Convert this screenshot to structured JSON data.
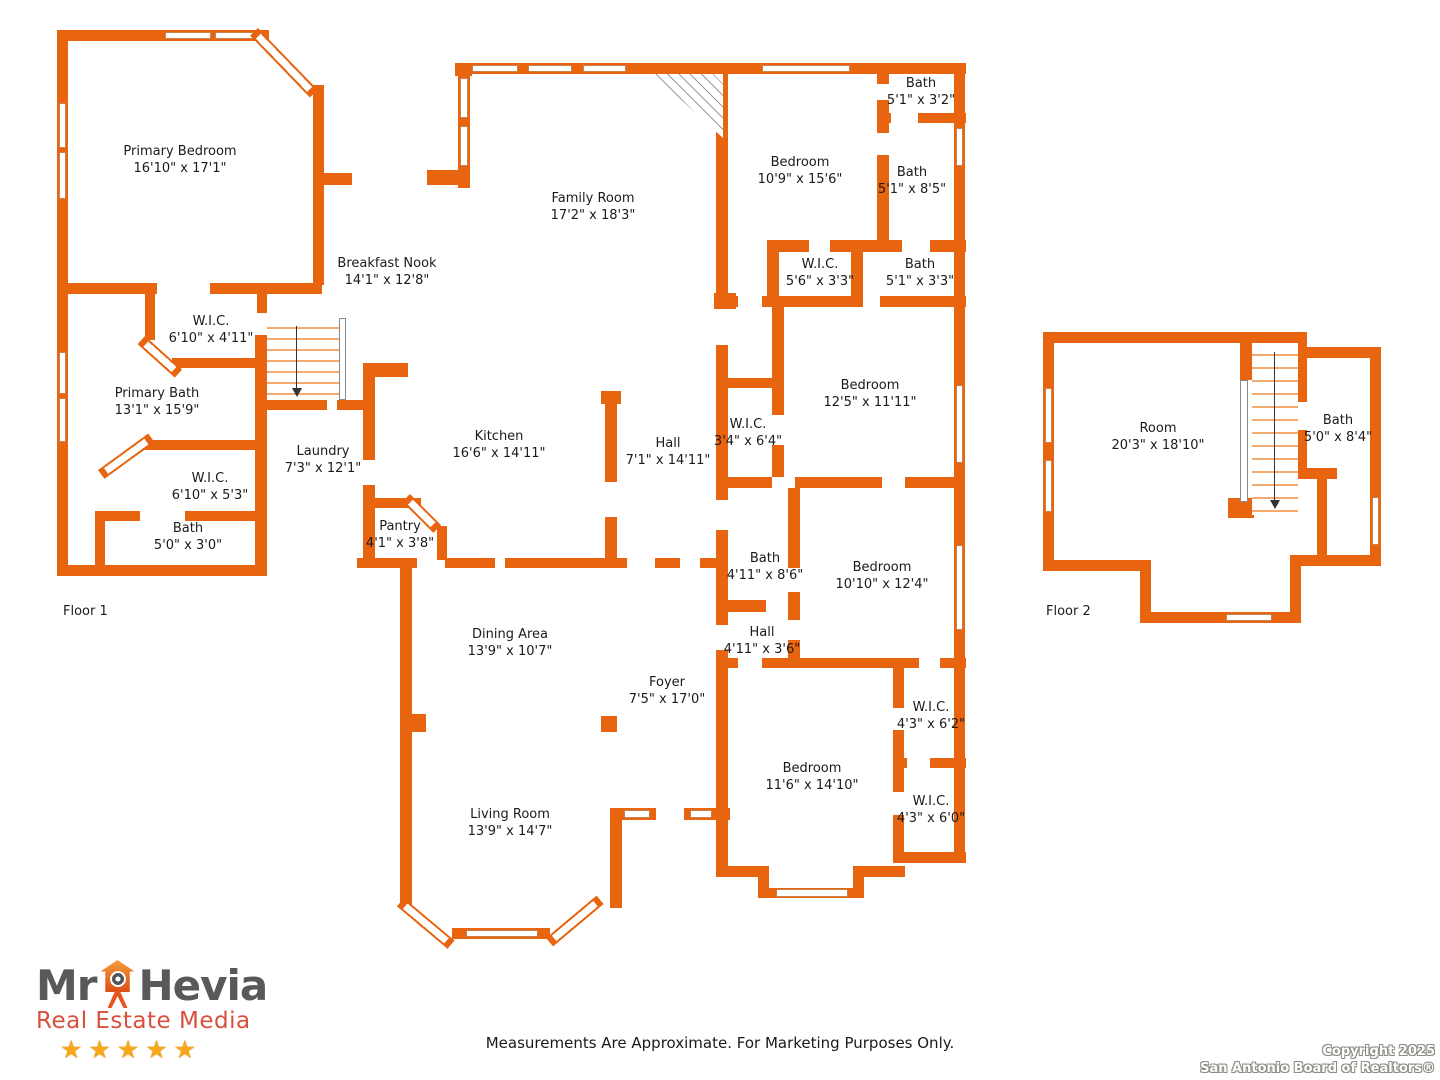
{
  "page": {
    "disclaimer": "Measurements Are Approximate. For Marketing Purposes Only.",
    "copyright": {
      "line1": "Copyright 2025",
      "line2": "San Antonio Board of Realtors®"
    }
  },
  "branding": {
    "name_part1": "Mr",
    "name_part2": "Hevia",
    "tagline": "Real Estate Media",
    "stars": "★★★★★",
    "colors": {
      "name_gray": "#58595B",
      "tagline_red": "#D94F3D",
      "star_gold": "#F7A71B",
      "house_orange": "#E8641A"
    }
  },
  "plan": {
    "wall_color": "#E8640E",
    "floors": [
      {
        "label": "Floor 1",
        "label_x": 63,
        "label_y": 604,
        "rooms": [
          {
            "name": "Primary Bedroom",
            "dims": "16'10\" x 17'1\"",
            "x": 180,
            "y": 161
          },
          {
            "name": "Family Room",
            "dims": "17'2\" x 18'3\"",
            "x": 593,
            "y": 208
          },
          {
            "name": "Breakfast Nook",
            "dims": "14'1\" x 12'8\"",
            "x": 387,
            "y": 273
          },
          {
            "name": "W.I.C.",
            "dims": "6'10\" x 4'11\"",
            "x": 211,
            "y": 331
          },
          {
            "name": "Primary Bath",
            "dims": "13'1\" x 15'9\"",
            "x": 157,
            "y": 403
          },
          {
            "name": "Laundry",
            "dims": "7'3\" x 12'1\"",
            "x": 323,
            "y": 461
          },
          {
            "name": "Kitchen",
            "dims": "16'6\" x 14'11\"",
            "x": 499,
            "y": 446
          },
          {
            "name": "Hall",
            "dims": "7'1\" x 14'11\"",
            "x": 668,
            "y": 453
          },
          {
            "name": "W.I.C.",
            "dims": "6'10\" x 5'3\"",
            "x": 210,
            "y": 488
          },
          {
            "name": "Bath",
            "dims": "5'0\" x 3'0\"",
            "x": 188,
            "y": 538
          },
          {
            "name": "Pantry",
            "dims": "4'1\" x 3'8\"",
            "x": 400,
            "y": 536
          },
          {
            "name": "Bedroom",
            "dims": "10'9\" x 15'6\"",
            "x": 800,
            "y": 172
          },
          {
            "name": "Bath",
            "dims": "5'1\" x 3'2\"",
            "x": 921,
            "y": 93
          },
          {
            "name": "Bath",
            "dims": "5'1\" x 8'5\"",
            "x": 912,
            "y": 182
          },
          {
            "name": "W.I.C.",
            "dims": "5'6\" x 3'3\"",
            "x": 820,
            "y": 274
          },
          {
            "name": "Bath",
            "dims": "5'1\" x 3'3\"",
            "x": 920,
            "y": 274
          },
          {
            "name": "Bedroom",
            "dims": "12'5\" x 11'11\"",
            "x": 870,
            "y": 395
          },
          {
            "name": "W.I.C.",
            "dims": "3'4\" x 6'4\"",
            "x": 748,
            "y": 434
          },
          {
            "name": "Bath",
            "dims": "4'11\" x 8'6\"",
            "x": 765,
            "y": 568
          },
          {
            "name": "Bedroom",
            "dims": "10'10\" x 12'4\"",
            "x": 882,
            "y": 577
          },
          {
            "name": "Hall",
            "dims": "4'11\" x 3'6\"",
            "x": 762,
            "y": 642
          },
          {
            "name": "Dining Area",
            "dims": "13'9\" x 10'7\"",
            "x": 510,
            "y": 644
          },
          {
            "name": "Foyer",
            "dims": "7'5\" x 17'0\"",
            "x": 667,
            "y": 692
          },
          {
            "name": "Bedroom",
            "dims": "11'6\" x 14'10\"",
            "x": 812,
            "y": 778
          },
          {
            "name": "W.I.C.",
            "dims": "4'3\" x 6'2\"",
            "x": 931,
            "y": 717
          },
          {
            "name": "W.I.C.",
            "dims": "4'3\" x 6'0\"",
            "x": 931,
            "y": 811
          },
          {
            "name": "Living Room",
            "dims": "13'9\" x 14'7\"",
            "x": 510,
            "y": 824
          }
        ]
      },
      {
        "label": "Floor 2",
        "label_x": 1046,
        "label_y": 604,
        "rooms": [
          {
            "name": "Room",
            "dims": "20'3\" x 18'10\"",
            "x": 1158,
            "y": 438
          },
          {
            "name": "Bath",
            "dims": "5'0\" x 8'4\"",
            "x": 1338,
            "y": 430
          }
        ]
      }
    ]
  }
}
